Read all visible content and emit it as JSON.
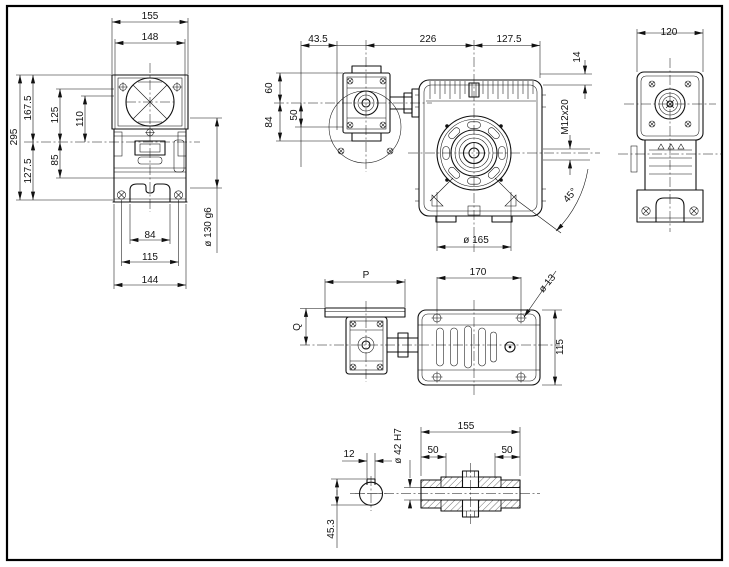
{
  "colors": {
    "line": "#111111",
    "background": "#ffffff"
  },
  "views": {
    "side": {
      "width_top": "155",
      "width_flange": "148",
      "height_total": "295",
      "height_above_axis": "167.5",
      "dim_125": "125",
      "dim_110": "110",
      "height_below_axis": "127.5",
      "dim_85": "85",
      "base_84": "84",
      "base_115": "115",
      "base_144": "144",
      "hub_dia": "ø 130 g6"
    },
    "front": {
      "dim_43_5": "43.5",
      "dim_226": "226",
      "dim_127_5": "127.5",
      "dim_60": "60",
      "dim_50": "50",
      "dim_84": "84",
      "dim_14": "14",
      "tapped_hole": "M12x20",
      "angle": "45°",
      "flange_dia": "ø 165"
    },
    "back": {
      "width": "120"
    },
    "plan": {
      "dim_p": "P",
      "dim_170": "170",
      "foot_hole_dia": "ø 13",
      "dim_q": "Q",
      "dim_115": "115"
    },
    "section": {
      "keyway_width": "12",
      "bore_dia": "ø 42 H7",
      "hub_length": "155",
      "bore_depth_left": "50",
      "bore_depth_right": "50",
      "keyway_depth": "45.3"
    }
  }
}
